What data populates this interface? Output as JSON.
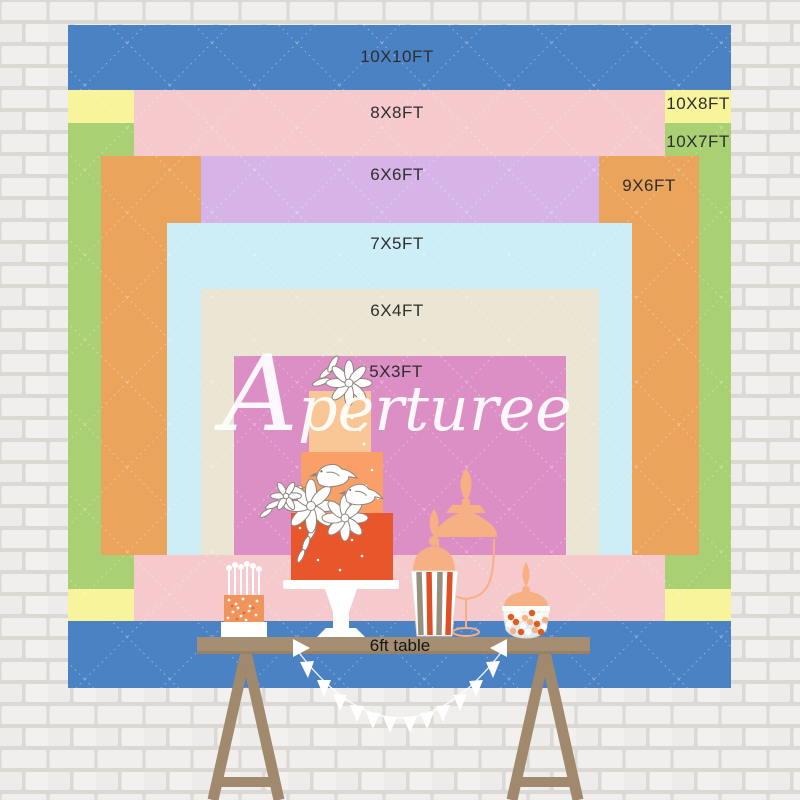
{
  "watermark": {
    "initial": "A",
    "rest": "perturee"
  },
  "backdrop": {
    "layers": [
      {
        "id": "10x10",
        "label": "10X10FT",
        "color": "#4a82c4"
      },
      {
        "id": "10x8",
        "label": "10X8FT",
        "color": "#f7f49c"
      },
      {
        "id": "10x7",
        "label": "10X7FT",
        "color": "#a9d072"
      },
      {
        "id": "8x8",
        "label": "8X8FT",
        "color": "#f6c9cc"
      },
      {
        "id": "9x6",
        "label": "9X6FT",
        "color": "#eaa45c"
      },
      {
        "id": "6x6",
        "label": "6X6FT",
        "color": "#d7b4e8"
      },
      {
        "id": "7x5",
        "label": "7X5FT",
        "color": "#cdeef7"
      },
      {
        "id": "6x4",
        "label": "6X4FT",
        "color": "#ebe5d3"
      },
      {
        "id": "5x3",
        "label": "5X3FT",
        "color": "#dc8fc4"
      }
    ],
    "stitch_color": "#ffffff"
  },
  "table": {
    "label": "6ft table",
    "wood_color": "#a68e72",
    "leg_color": "#a0896c"
  },
  "palette": {
    "wall_mortar": "#dcd8d4",
    "wall_brick": "#f1efed",
    "label_text": "#2e2e2e",
    "watermark_white": "#ffffff",
    "cake_tier_top": "#f9c795",
    "cake_tier_mid": "#f8a068",
    "cake_tier_bottom": "#e8572b",
    "funfetti_cake": "#f0945c",
    "peach_jar": "#f6b084",
    "stripe_orange": "#de5127",
    "stripe_taupe": "#98907f",
    "bunting_white": "#ffffff"
  }
}
